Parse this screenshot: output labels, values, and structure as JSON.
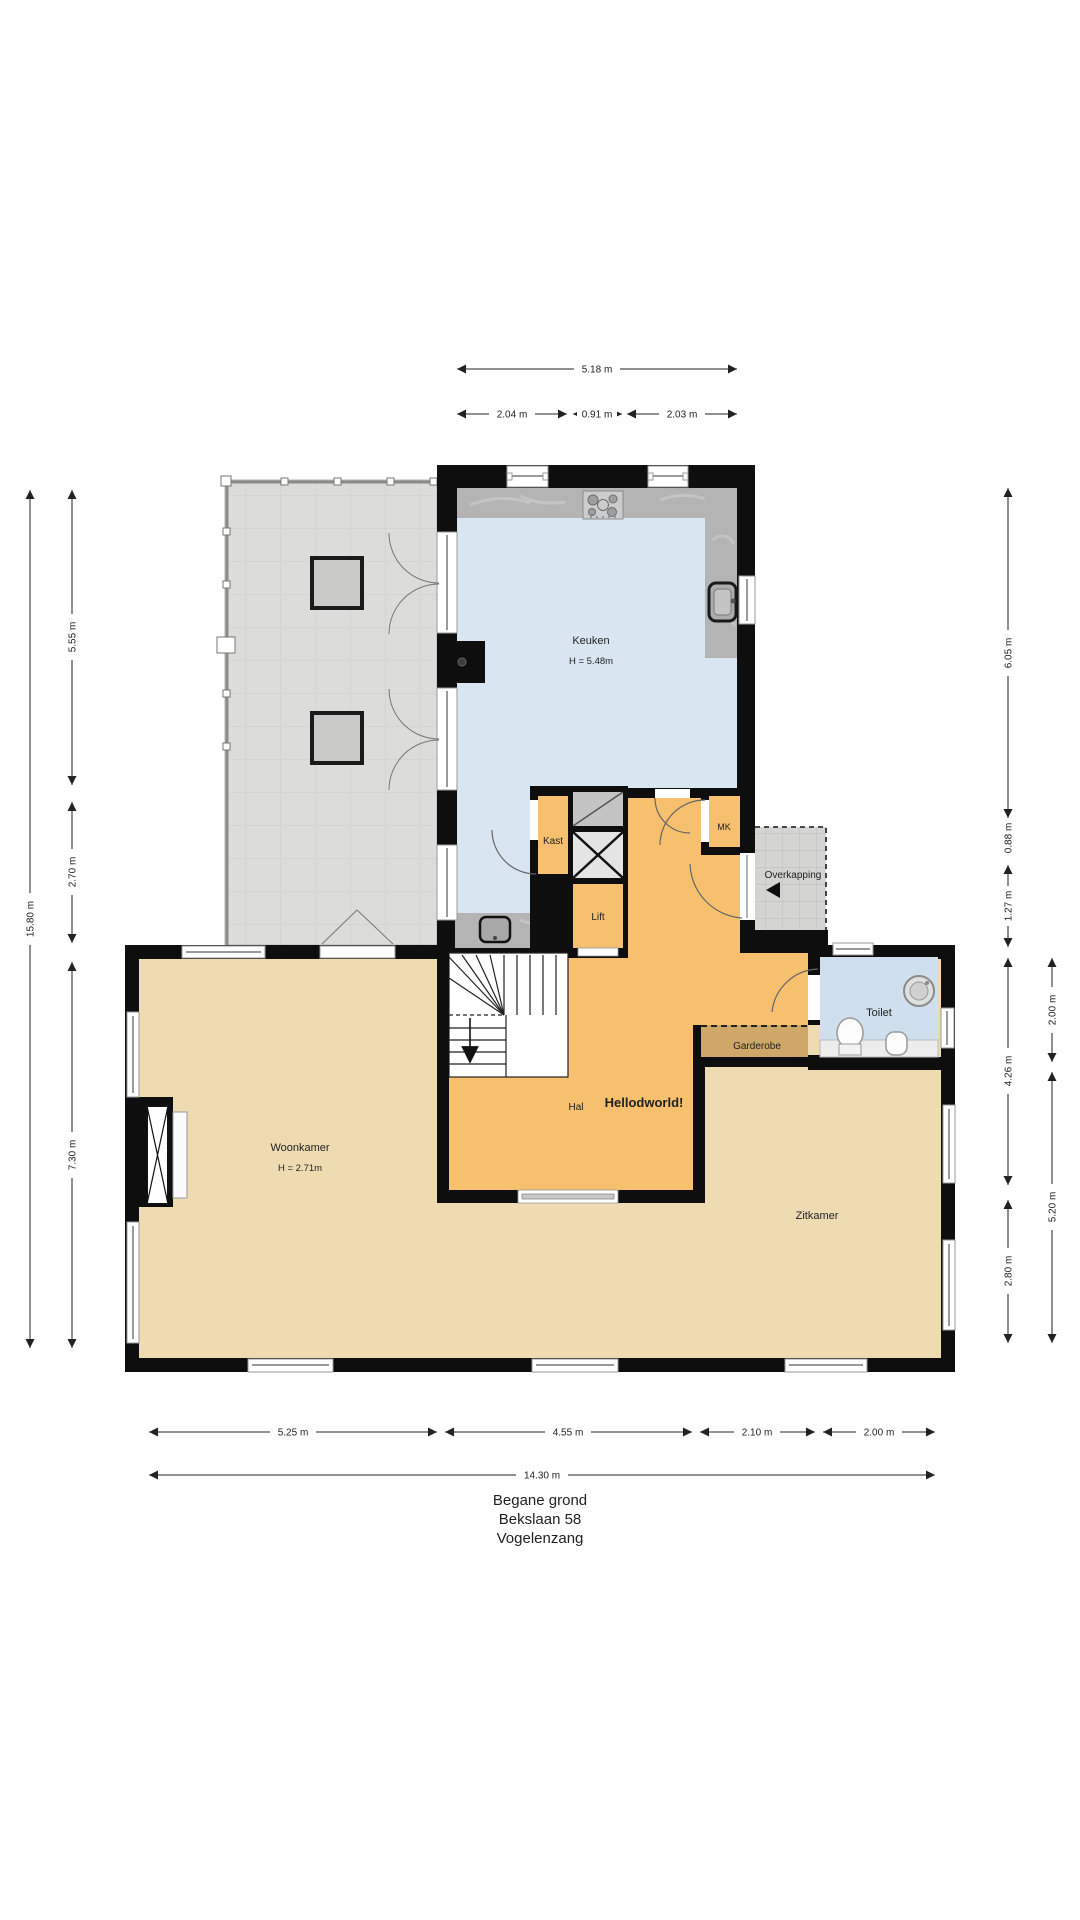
{
  "plan": {
    "title_lines": {
      "floor": "Begane grond",
      "street": "Bekslaan 58",
      "city": "Vogelenzang"
    },
    "rooms": {
      "keuken": {
        "name": "Keuken",
        "height": "H = 5.48m"
      },
      "woonkamer": {
        "name": "Woonkamer",
        "height": "H = 2.71m"
      },
      "zitkamer": {
        "name": "Zitkamer"
      },
      "hal": {
        "name": "Hal"
      },
      "hello_text": "Hellodworld!",
      "kast": {
        "name": "Kast"
      },
      "lift": {
        "name": "Lift"
      },
      "mk": {
        "name": "MK"
      },
      "overkapping": {
        "name": "Overkapping"
      },
      "toilet": {
        "name": "Toilet"
      },
      "garderobe": {
        "name": "Garderobe"
      }
    },
    "dims": {
      "t_total": "5.18 m",
      "t1": "2.04 m",
      "t2": "0.91 m",
      "t3": "2.03 m",
      "l_total": "15.80 m",
      "l1": "5.55 m",
      "l2": "2.70 m",
      "l3": "7.30 m",
      "r1": "6.05 m",
      "r2": "0.88 m",
      "r3": "1.27 m",
      "r4": "4.26 m",
      "r5": "2.80 m",
      "r6": "2.00 m",
      "r7": "5.20 m",
      "b1": "5.25 m",
      "b2": "4.55 m",
      "b3": "2.10 m",
      "b4": "2.00 m",
      "b_total": "14.30 m"
    },
    "colors": {
      "wall": "#0e0e0e",
      "kitchen_floor": "#d9e5f1",
      "hall_floor": "#f6c06e",
      "living_floor": "#eedbb2",
      "garderobe_floor": "#cfa768",
      "terrace": "#dcdcda",
      "counter": "#b4b4b4",
      "dim_line": "#222222"
    }
  }
}
